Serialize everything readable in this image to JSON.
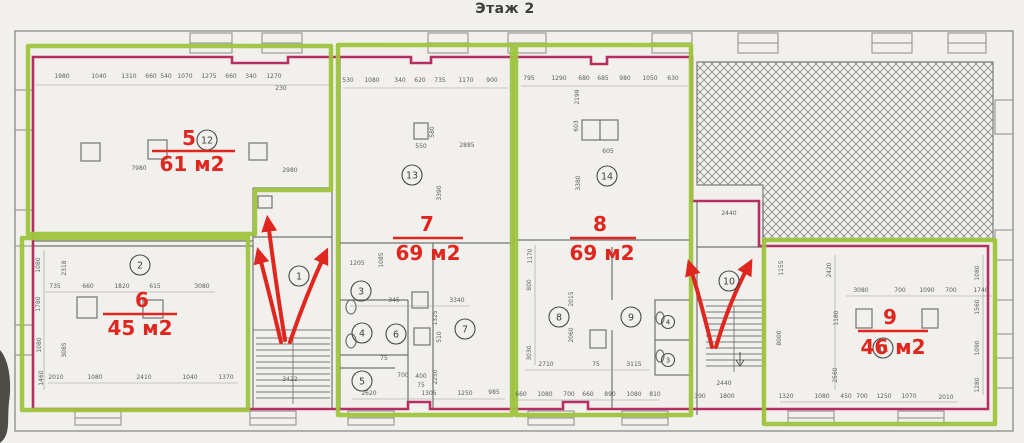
{
  "title": "Этаж 2",
  "colors": {
    "unit_outline_green": "#9ec43d",
    "wall_trace_magenta": "#b53060",
    "annotation_red": "#e0271f",
    "drawing_grey": "#6f6f6f",
    "paper": "#f1f0ed"
  },
  "apartments": [
    {
      "num": "5",
      "area": "61 м2",
      "nx": 189,
      "ny": 145,
      "ux1": 152,
      "ux2": 235,
      "uy": 151,
      "ax": 192,
      "ay": 171
    },
    {
      "num": "6",
      "area": "45 м2",
      "nx": 142,
      "ny": 307,
      "ux1": 103,
      "ux2": 177,
      "uy": 314,
      "ax": 140,
      "ay": 335
    },
    {
      "num": "7",
      "area": "69 м2",
      "nx": 427,
      "ny": 231,
      "ux1": 393,
      "ux2": 463,
      "uy": 238,
      "ax": 428,
      "ay": 260
    },
    {
      "num": "8",
      "area": "69 м2",
      "nx": 600,
      "ny": 231,
      "ux1": 570,
      "ux2": 636,
      "uy": 238,
      "ax": 602,
      "ay": 260
    },
    {
      "num": "9",
      "area": "46 м2",
      "nx": 890,
      "ny": 324,
      "ux1": 858,
      "ux2": 928,
      "uy": 331,
      "ax": 893,
      "ay": 354
    }
  ],
  "room_circles": [
    {
      "n": "12",
      "x": 207,
      "y": 140
    },
    {
      "n": "2",
      "x": 140,
      "y": 265
    },
    {
      "n": "13",
      "x": 412,
      "y": 175
    },
    {
      "n": "14",
      "x": 607,
      "y": 176
    },
    {
      "n": "1",
      "x": 299,
      "y": 276
    },
    {
      "n": "3",
      "x": 361,
      "y": 291
    },
    {
      "n": "4",
      "x": 362,
      "y": 333
    },
    {
      "n": "6",
      "x": 396,
      "y": 334
    },
    {
      "n": "5",
      "x": 362,
      "y": 381
    },
    {
      "n": "7",
      "x": 465,
      "y": 329
    },
    {
      "n": "8",
      "x": 559,
      "y": 317
    },
    {
      "n": "9",
      "x": 631,
      "y": 317
    },
    {
      "n": "10",
      "x": 729,
      "y": 281
    },
    {
      "n": "11",
      "x": 883,
      "y": 348
    },
    {
      "n": "4",
      "x": 668,
      "y": 322,
      "s": 1
    },
    {
      "n": "3",
      "x": 668,
      "y": 360,
      "s": 1
    }
  ],
  "stair_arrows": {
    "left_count": 3,
    "right_count": 2
  },
  "dimensions": [
    {
      "t": "1980",
      "x": 62,
      "y": 78
    },
    {
      "t": "1040",
      "x": 99,
      "y": 78
    },
    {
      "t": "1310",
      "x": 129,
      "y": 78
    },
    {
      "t": "660",
      "x": 151,
      "y": 78
    },
    {
      "t": "540",
      "x": 166,
      "y": 78
    },
    {
      "t": "1070",
      "x": 185,
      "y": 78
    },
    {
      "t": "1275",
      "x": 209,
      "y": 78
    },
    {
      "t": "660",
      "x": 231,
      "y": 78
    },
    {
      "t": "340",
      "x": 251,
      "y": 78
    },
    {
      "t": "1270",
      "x": 274,
      "y": 78
    },
    {
      "t": "230",
      "x": 281,
      "y": 90
    },
    {
      "t": "7980",
      "x": 139,
      "y": 170
    },
    {
      "t": "2980",
      "x": 290,
      "y": 172
    },
    {
      "t": "1080",
      "x": 40,
      "y": 265,
      "v": 1
    },
    {
      "t": "1780",
      "x": 40,
      "y": 304,
      "v": 1
    },
    {
      "t": "1080",
      "x": 41,
      "y": 345,
      "v": 1
    },
    {
      "t": "1460",
      "x": 43,
      "y": 378,
      "v": 1
    },
    {
      "t": "2318",
      "x": 66,
      "y": 268,
      "v": 1
    },
    {
      "t": "3085",
      "x": 66,
      "y": 350,
      "v": 1
    },
    {
      "t": "735",
      "x": 55,
      "y": 288
    },
    {
      "t": "660",
      "x": 88,
      "y": 288
    },
    {
      "t": "1820",
      "x": 122,
      "y": 288
    },
    {
      "t": "615",
      "x": 155,
      "y": 288
    },
    {
      "t": "3080",
      "x": 202,
      "y": 288
    },
    {
      "t": "2010",
      "x": 56,
      "y": 379
    },
    {
      "t": "1080",
      "x": 95,
      "y": 379
    },
    {
      "t": "2410",
      "x": 144,
      "y": 379
    },
    {
      "t": "1040",
      "x": 190,
      "y": 379
    },
    {
      "t": "1370",
      "x": 226,
      "y": 379
    },
    {
      "t": "3422",
      "x": 290,
      "y": 381
    },
    {
      "t": "530",
      "x": 348,
      "y": 82
    },
    {
      "t": "1080",
      "x": 372,
      "y": 82
    },
    {
      "t": "340",
      "x": 400,
      "y": 82
    },
    {
      "t": "620",
      "x": 420,
      "y": 82
    },
    {
      "t": "735",
      "x": 440,
      "y": 82
    },
    {
      "t": "1170",
      "x": 466,
      "y": 82
    },
    {
      "t": "900",
      "x": 492,
      "y": 82
    },
    {
      "t": "550",
      "x": 421,
      "y": 148
    },
    {
      "t": "2885",
      "x": 467,
      "y": 147
    },
    {
      "t": "580",
      "x": 434,
      "y": 132,
      "v": 1
    },
    {
      "t": "3390",
      "x": 441,
      "y": 193,
      "v": 1
    },
    {
      "t": "1205",
      "x": 357,
      "y": 265
    },
    {
      "t": "1085",
      "x": 383,
      "y": 260,
      "v": 1
    },
    {
      "t": "345",
      "x": 394,
      "y": 302
    },
    {
      "t": "3340",
      "x": 457,
      "y": 302
    },
    {
      "t": "75",
      "x": 384,
      "y": 360
    },
    {
      "t": "700",
      "x": 403,
      "y": 377
    },
    {
      "t": "400",
      "x": 421,
      "y": 378
    },
    {
      "t": "75",
      "x": 421,
      "y": 387
    },
    {
      "t": "1325",
      "x": 437,
      "y": 318,
      "v": 1
    },
    {
      "t": "510",
      "x": 441,
      "y": 337,
      "v": 1
    },
    {
      "t": "2250",
      "x": 437,
      "y": 377,
      "v": 1
    },
    {
      "t": "2620",
      "x": 369,
      "y": 395
    },
    {
      "t": "1305",
      "x": 429,
      "y": 395
    },
    {
      "t": "1250",
      "x": 465,
      "y": 395
    },
    {
      "t": "985",
      "x": 494,
      "y": 394
    },
    {
      "t": "795",
      "x": 529,
      "y": 80
    },
    {
      "t": "1290",
      "x": 559,
      "y": 80
    },
    {
      "t": "680",
      "x": 584,
      "y": 80
    },
    {
      "t": "685",
      "x": 603,
      "y": 80
    },
    {
      "t": "980",
      "x": 625,
      "y": 80
    },
    {
      "t": "1050",
      "x": 650,
      "y": 80
    },
    {
      "t": "630",
      "x": 673,
      "y": 80
    },
    {
      "t": "2199",
      "x": 579,
      "y": 97,
      "v": 1
    },
    {
      "t": "603",
      "x": 578,
      "y": 126,
      "v": 1
    },
    {
      "t": "605",
      "x": 608,
      "y": 153
    },
    {
      "t": "3380",
      "x": 580,
      "y": 183,
      "v": 1
    },
    {
      "t": "1170",
      "x": 532,
      "y": 256,
      "v": 1
    },
    {
      "t": "800",
      "x": 531,
      "y": 285,
      "v": 1
    },
    {
      "t": "3030",
      "x": 531,
      "y": 353,
      "v": 1
    },
    {
      "t": "2015",
      "x": 573,
      "y": 299,
      "v": 1
    },
    {
      "t": "2060",
      "x": 573,
      "y": 335,
      "v": 1
    },
    {
      "t": "2710",
      "x": 546,
      "y": 366
    },
    {
      "t": "75",
      "x": 596,
      "y": 366
    },
    {
      "t": "3115",
      "x": 634,
      "y": 366
    },
    {
      "t": "660",
      "x": 521,
      "y": 396
    },
    {
      "t": "1080",
      "x": 545,
      "y": 396
    },
    {
      "t": "700",
      "x": 569,
      "y": 396
    },
    {
      "t": "660",
      "x": 588,
      "y": 396
    },
    {
      "t": "890",
      "x": 610,
      "y": 396
    },
    {
      "t": "1080",
      "x": 634,
      "y": 396
    },
    {
      "t": "810",
      "x": 655,
      "y": 396
    },
    {
      "t": "2440",
      "x": 729,
      "y": 215
    },
    {
      "t": "2440",
      "x": 724,
      "y": 385
    },
    {
      "t": "390",
      "x": 700,
      "y": 398
    },
    {
      "t": "1800",
      "x": 727,
      "y": 398
    },
    {
      "t": "1155",
      "x": 783,
      "y": 268,
      "v": 1
    },
    {
      "t": "8000",
      "x": 781,
      "y": 338,
      "v": 1
    },
    {
      "t": "2420",
      "x": 831,
      "y": 270,
      "v": 1
    },
    {
      "t": "1180",
      "x": 838,
      "y": 318,
      "v": 1
    },
    {
      "t": "2560",
      "x": 837,
      "y": 375,
      "v": 1
    },
    {
      "t": "3080",
      "x": 861,
      "y": 292
    },
    {
      "t": "700",
      "x": 900,
      "y": 292
    },
    {
      "t": "1090",
      "x": 927,
      "y": 292
    },
    {
      "t": "700",
      "x": 951,
      "y": 292
    },
    {
      "t": "1740",
      "x": 981,
      "y": 292
    },
    {
      "t": "1080",
      "x": 979,
      "y": 273,
      "v": 1
    },
    {
      "t": "1560",
      "x": 979,
      "y": 307,
      "v": 1
    },
    {
      "t": "1090",
      "x": 979,
      "y": 348,
      "v": 1
    },
    {
      "t": "1280",
      "x": 979,
      "y": 385,
      "v": 1
    },
    {
      "t": "1320",
      "x": 786,
      "y": 398
    },
    {
      "t": "1080",
      "x": 822,
      "y": 398
    },
    {
      "t": "450",
      "x": 846,
      "y": 398
    },
    {
      "t": "700",
      "x": 862,
      "y": 398
    },
    {
      "t": "1250",
      "x": 884,
      "y": 398
    },
    {
      "t": "1070",
      "x": 909,
      "y": 398
    },
    {
      "t": "2010",
      "x": 946,
      "y": 399
    }
  ]
}
